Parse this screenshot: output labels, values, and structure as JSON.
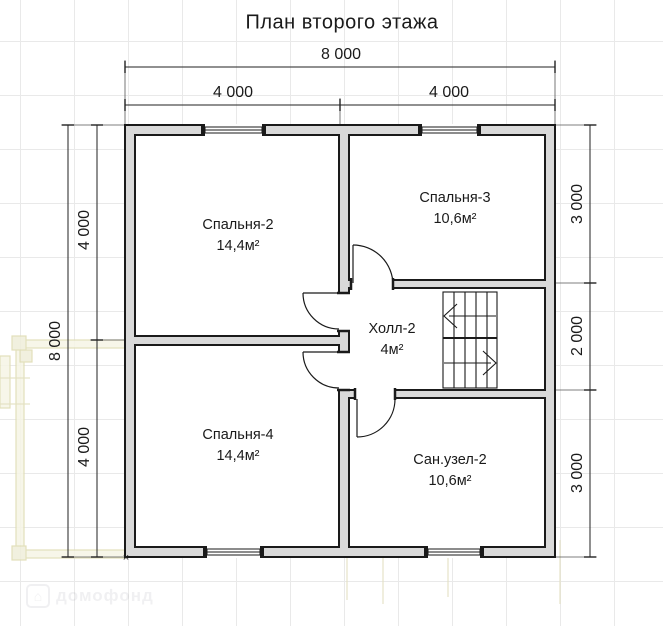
{
  "title": "План второго этажа",
  "dims": {
    "top_total": "8 000",
    "top_seg1": "4 000",
    "top_seg2": "4 000",
    "left_total": "8 000",
    "left_seg1": "4 000",
    "left_seg2": "4 000",
    "right_seg1": "3 000",
    "right_seg2": "2 000",
    "right_seg3": "3 000"
  },
  "rooms": [
    {
      "name": "Спальня-2",
      "area": "14,4м²"
    },
    {
      "name": "Спальня-3",
      "area": "10,6м²"
    },
    {
      "name": "Холл-2",
      "area": "4м²"
    },
    {
      "name": "Спальня-4",
      "area": "14,4м²"
    },
    {
      "name": "Сан.узел-2",
      "area": "10,6м²"
    }
  ],
  "corner_marker": "×",
  "watermark": {
    "icon": "⌂",
    "text": "домофонд"
  },
  "colors": {
    "wall_fill": "#d9d9d9",
    "line": "#1a1a1a",
    "dim_line": "#333333",
    "grid": "#e9e9e9",
    "ghost": "#dedbb0"
  }
}
